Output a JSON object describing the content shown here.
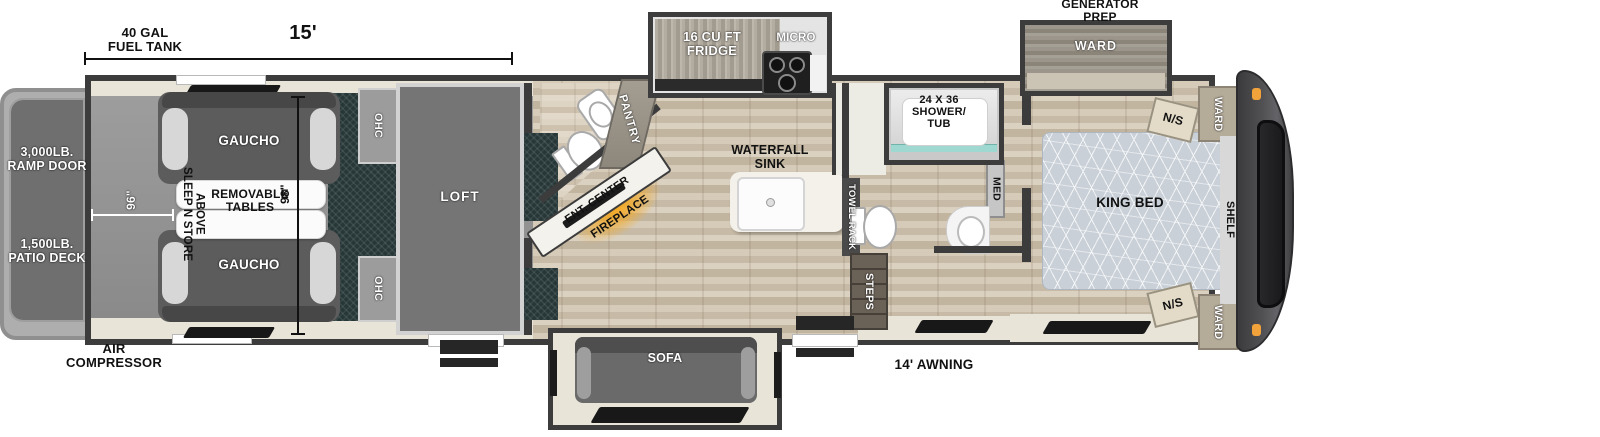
{
  "dims": {
    "fuel_tank": "40 GAL\nFUEL TANK",
    "length_15": "15'",
    "width_96": "96\"",
    "length_98": "98\""
  },
  "exterior": {
    "ramp_door": "3,000LB.\nRAMP DOOR",
    "patio_deck": "1,500LB.\nPATIO DECK",
    "air_compressor": "AIR\nCOMPRESSOR",
    "awning": "14' AWNING",
    "generator_prep": "GENERATOR\nPREP"
  },
  "garage": {
    "gaucho_top": "GAUCHO",
    "gaucho_bottom": "GAUCHO",
    "removable_tables": "REMOVABLE\nTABLES",
    "sleep_n_store": "SLEEP N STORE\nABOVE",
    "ohc_top": "OHC",
    "ohc_bottom": "OHC",
    "loft": "LOFT"
  },
  "living": {
    "pantry": "PANTRY",
    "ent_center": "ENT. CENTER",
    "fireplace": "FIREPLACE",
    "sofa": "SOFA"
  },
  "kitchen": {
    "fridge": "16 CU FT\nFRIDGE",
    "micro": "MICRO",
    "waterfall_sink": "WATERFALL\nSINK"
  },
  "bath": {
    "shower": "24 X 36\nSHOWER/\nTUB",
    "towel_rack": "TOWEL RACK",
    "med": "MED",
    "steps": "STEPS"
  },
  "bedroom": {
    "king_bed": "KING BED",
    "ns_front": "N/S",
    "ns_rear": "N/S",
    "ward_slide": "WARD",
    "ward_front": "WARD",
    "ward_rear": "WARD",
    "shelf": "SHELF"
  },
  "colors": {
    "wall": "#3c3c3c",
    "wood_floor": "#cfc3b0",
    "cream_floor": "#e9e4d8",
    "carpet_teal": "#273737",
    "marker_light_orange": "#f2a23a",
    "fireplace_glow": "#f6a81e"
  }
}
